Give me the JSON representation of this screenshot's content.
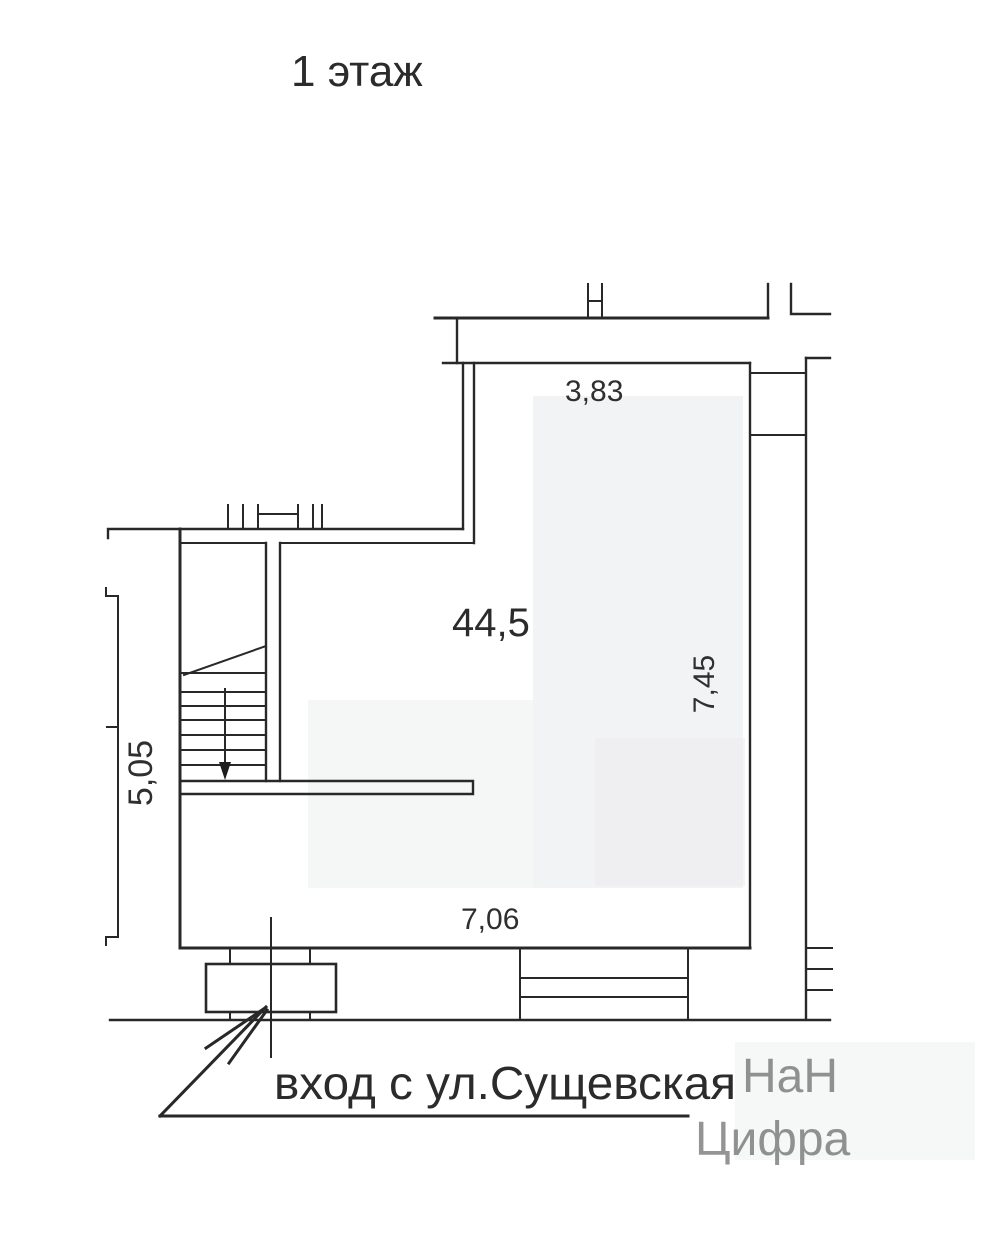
{
  "page": {
    "title": "1 этаж"
  },
  "plan": {
    "type": "floor-plan",
    "area_label": "44,5",
    "dimensions": {
      "top": "3,83",
      "right": "7,45",
      "left": "5,05",
      "bottom": "7,06"
    },
    "entrance_label": "вход с ул.Сущевская",
    "features": [
      "staircase-with-down-arrow",
      "entrance-porch",
      "storefront-window",
      "right-utility-shaft"
    ]
  },
  "watermark": {
    "line1": "НаН",
    "line2": "Цифра"
  },
  "colors": {
    "wall_line": "#282828",
    "entrance_red": "#c1242e",
    "text_dark": "#2b2b2b",
    "room_tint": "#f2f3f4",
    "watermark_gray": "#e4e7e9"
  }
}
